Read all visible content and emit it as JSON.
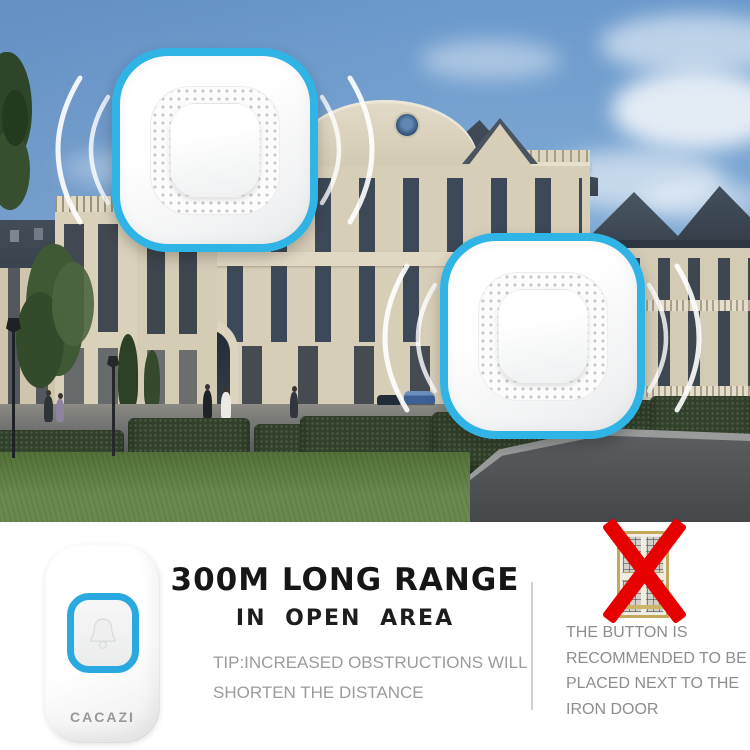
{
  "brand": {
    "name": "CACAZI"
  },
  "headline": {
    "title": "300M LONG RANGE",
    "subtitle": "IN OPEN AREA"
  },
  "tip": {
    "lines": [
      "TIP:INCREASED OBSTRUCTIONS WILL",
      "SHORTEN THE DISTANCE"
    ]
  },
  "door_note": {
    "lines": [
      "THE BUTTON IS",
      "RECOMMENDED TO BE",
      "PLACED NEXT TO THE",
      "IRON DOOR"
    ]
  },
  "colors": {
    "accent_cyan": "#30b4e6",
    "button_ring_cyan": "#29a9df",
    "alert_red": "#e60000",
    "headline_black": "#161616",
    "tip_gray": "#9b9b9b",
    "note_gray": "#8d8d8d",
    "door_gold": "#c4a85c",
    "sky_blue": "#6b99cc",
    "building_cream": "#d7ceb8",
    "hedge_green": "#31412a",
    "grass_green": "#5d7f3f",
    "roof_dark": "#3b4754"
  },
  "icons": {
    "receiver_waves": "signal-wave-arcs",
    "transmitter_button": "bell-icon",
    "prohibition": "red-x-icon",
    "door_figure": "iron-door-image"
  }
}
